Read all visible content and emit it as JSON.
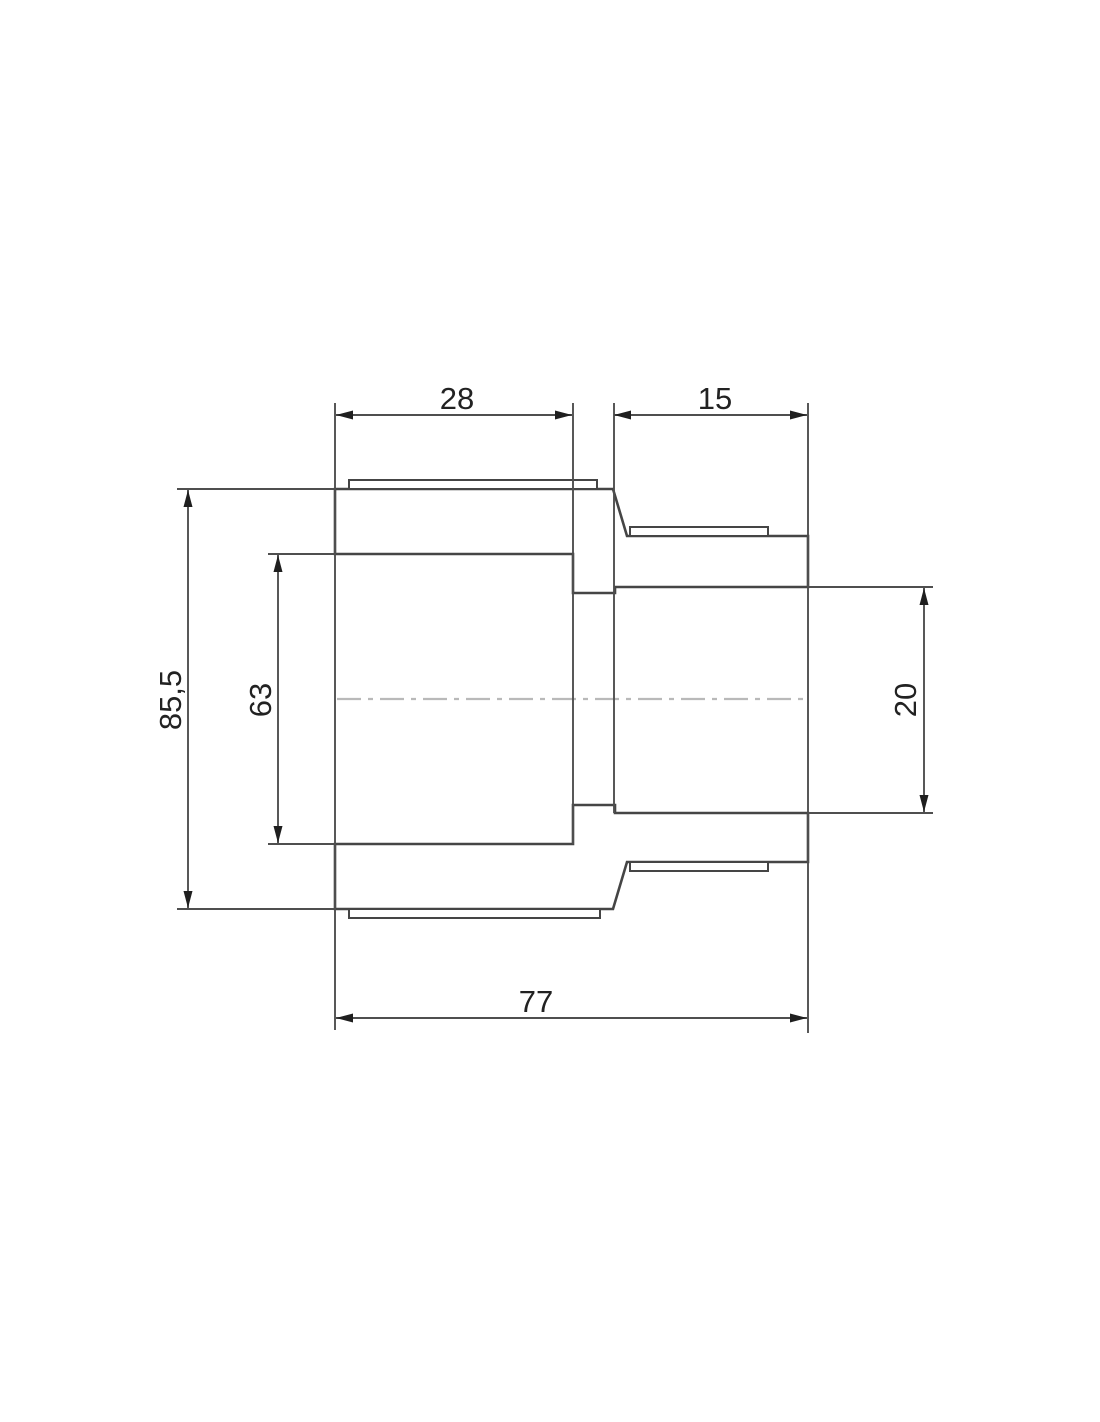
{
  "drawing": {
    "title": "reducing-coupling-section",
    "kind": "technical dimension drawing, cross-section of a reducing pipe coupling",
    "colors": {
      "background": "#ffffff",
      "line": "#454545",
      "dimension_line": "#4f4f4f",
      "centerline": "#b9b9b9",
      "text": "#222222"
    },
    "dimensions": {
      "left_socket_depth": {
        "label": "28"
      },
      "right_socket_depth": {
        "label": "15"
      },
      "outer_diameter": {
        "label": "85,5"
      },
      "left_bore_diameter": {
        "label": "63"
      },
      "right_bore_diameter": {
        "label": "20"
      },
      "overall_length": {
        "label": "77"
      }
    }
  }
}
